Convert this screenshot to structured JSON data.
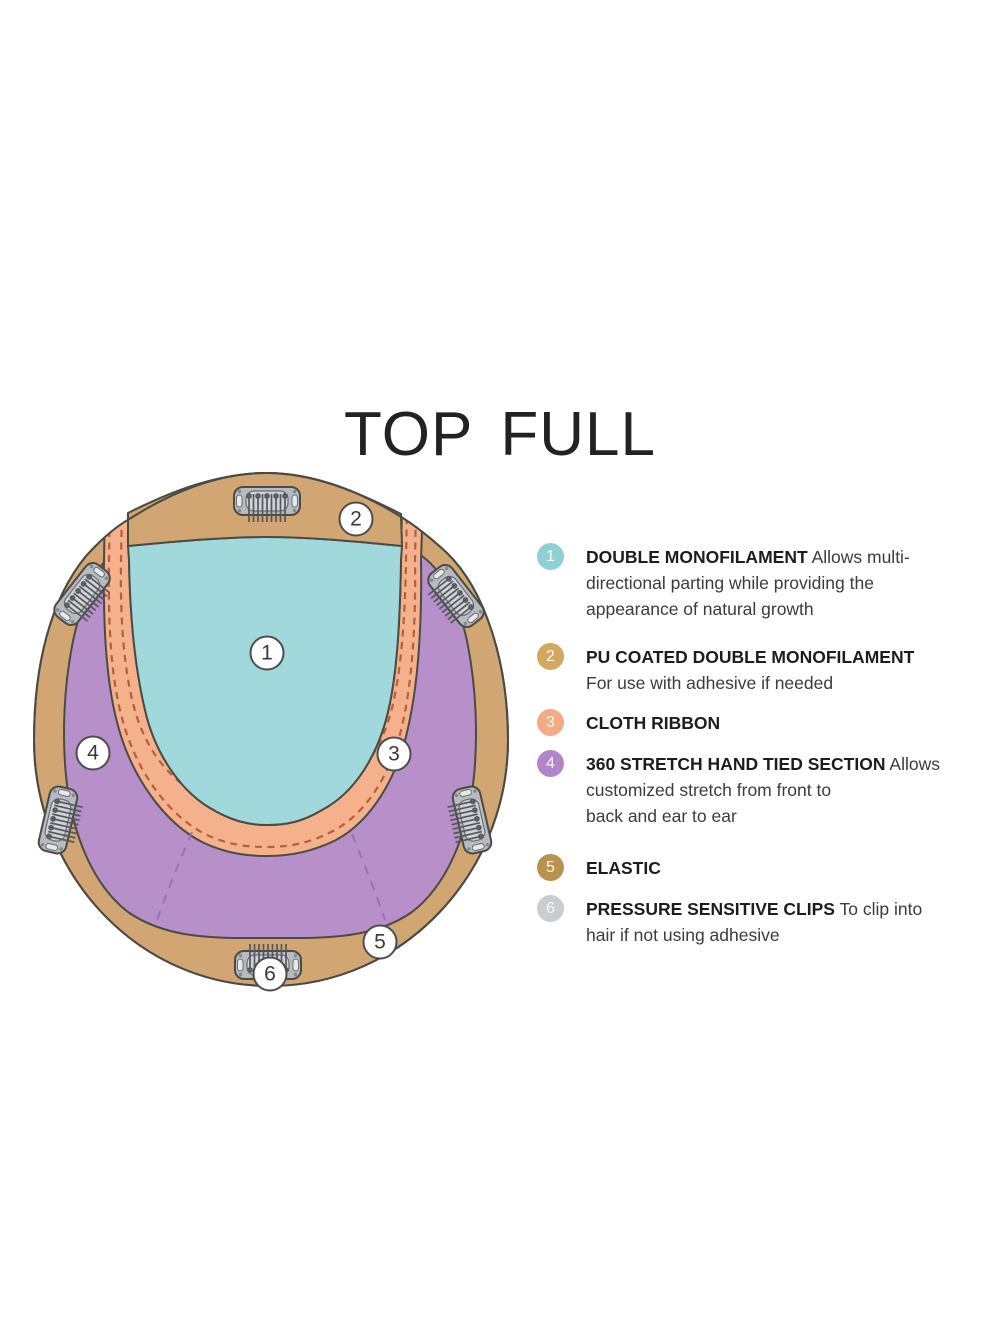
{
  "title": "TOP FULL",
  "diagram": {
    "markers": [
      "1",
      "2",
      "3",
      "4",
      "5",
      "6"
    ],
    "colors": {
      "cap_tan": "#d2a672",
      "monofilament_teal": "#a0d8db",
      "stretch_purple": "#b78fc9",
      "ribbon_salmon": "#f4b18b",
      "ribbon_stitch": "#b2603e",
      "dart_dash": "#9a71b5",
      "outline": "#4b4b45",
      "clip_gray": "#b7babf"
    }
  },
  "legend": {
    "items": [
      {
        "num": "1",
        "color": "#8fd0d4",
        "title": "DOUBLE MONOFILAMENT",
        "desc": "Allows multi-\ndirectional parting while providing the\nappearance of natural growth"
      },
      {
        "num": "2",
        "color": "#d2a75f",
        "title": "PU COATED DOUBLE MONOFILAMENT",
        "desc": "\nFor use with adhesive if needed"
      },
      {
        "num": "3",
        "color": "#f2ab84",
        "title": "CLOTH RIBBON",
        "desc": ""
      },
      {
        "num": "4",
        "color": "#b285ca",
        "title": "360 STRETCH HAND TIED SECTION",
        "desc": "Allows\ncustomized stretch from front to\nback and ear to ear"
      },
      {
        "num": "5",
        "color": "#bb9150",
        "title": "ELASTIC",
        "desc": ""
      },
      {
        "num": "6",
        "color": "#c8cdd1",
        "title": "PRESSURE SENSITIVE CLIPS",
        "desc": "To clip into\nhair if not using adhesive"
      }
    ]
  }
}
